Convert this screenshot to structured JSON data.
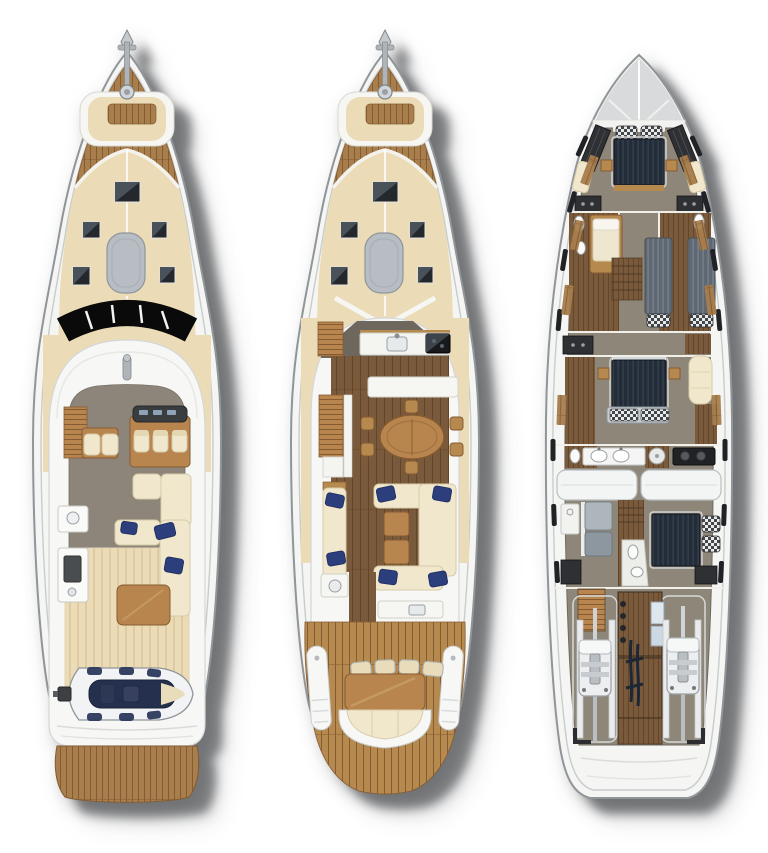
{
  "meta": {
    "description": "Illustrated top-view deck plans of a motor yacht shown at three levels: flybridge deck, main deck and lower deck",
    "canvas": {
      "width": 768,
      "height": 853
    }
  },
  "colors": {
    "background": "#ffffff",
    "shadow": "rgba(30,32,35,0.5)",
    "hull-white": "#f5f5f3",
    "hull-stroke": "#8f9598",
    "hull-line": "#c7cccd",
    "white-surface": "#f7f7f5",
    "deck-cream": "#ebdcb7",
    "deck-cream-stripe": "#decba1",
    "teak": "#a87e4d",
    "teak-light": "#b6894f",
    "teak-dark": "#855c32",
    "wood-floor": "#7a5a3c",
    "wood-floor-dark": "#644626",
    "floor-gray": "#8d8579",
    "floor-taupe": "#8e8678",
    "furniture-wood": "#b9854e",
    "upholstery-cream": "#f1e7cd",
    "pillow-navy": "#2c3e7b",
    "bed-navy": "#232c38",
    "bed-navy-stripe": "#36444f",
    "bed-gray": "#5f6872",
    "bed-gray-stripe": "#7b8590",
    "pad-gray": "#b7bdc3",
    "hatch-dark": "#24282d",
    "hatch-sheen": "#49525a",
    "windshield-black": "#0a0a0a",
    "metal-gray": "#aeb4b8",
    "dark-panel": "#2e3033",
    "engine-white": "#eceeef",
    "tender-navy": "#24304d",
    "galley-gray": "#6e675e"
  },
  "boats": [
    {
      "name": "flybridge-deck-plan",
      "level": "flybridge deck",
      "areas": [
        "bow-anchor-windlass",
        "foredeck-teak",
        "foredeck-sunpad",
        "deck-hatches",
        "liferaft-pad",
        "black-windshield",
        "flybridge-helm-with-three-seats",
        "flybridge-bench",
        "wet-bar-with-sink",
        "grill-counter",
        "flybridge-l-sofa-with-navy-pillows",
        "teak-coffee-table",
        "aft-sunpad-deck",
        "tender-on-deck-with-outboard",
        "teak-swim-platform"
      ]
    },
    {
      "name": "main-deck-plan",
      "level": "main deck",
      "areas": [
        "bow-anchor-windlass",
        "foredeck-teak",
        "foredeck-sunpad",
        "deck-hatches",
        "liferaft-pad",
        "galley-with-sink-and-cooktop",
        "stairs-up",
        "stairs-down",
        "sideboard",
        "oval-dining-table-six-chairs",
        "salon-u-sofa-with-navy-pillows",
        "salon-bench",
        "two-wood-ottomans",
        "aft-wet-counter",
        "aft-deck-teak",
        "aft-table-with-cushions",
        "curved-aft-bench",
        "port-boarding-stairs",
        "starboard-boarding-stairs"
      ]
    },
    {
      "name": "lower-deck-plan",
      "level": "lower deck",
      "areas": [
        "bow-locker-deck",
        "vip-cabin-navy-bed",
        "vip-wardrobes",
        "guest-cabin-port",
        "guest-cabin-starboard-twin-beds",
        "guest-bathrooms",
        "midship-lobby-stairs",
        "master-cabin-navy-bed",
        "master-sofa",
        "master-bathroom-twin-sinks",
        "crew-galley-stove",
        "fuel-tanks",
        "crew-bunks",
        "crew-cabin-bed",
        "crew-bathroom",
        "engine-room-twin-engines",
        "engine-walkway",
        "transom"
      ]
    }
  ]
}
